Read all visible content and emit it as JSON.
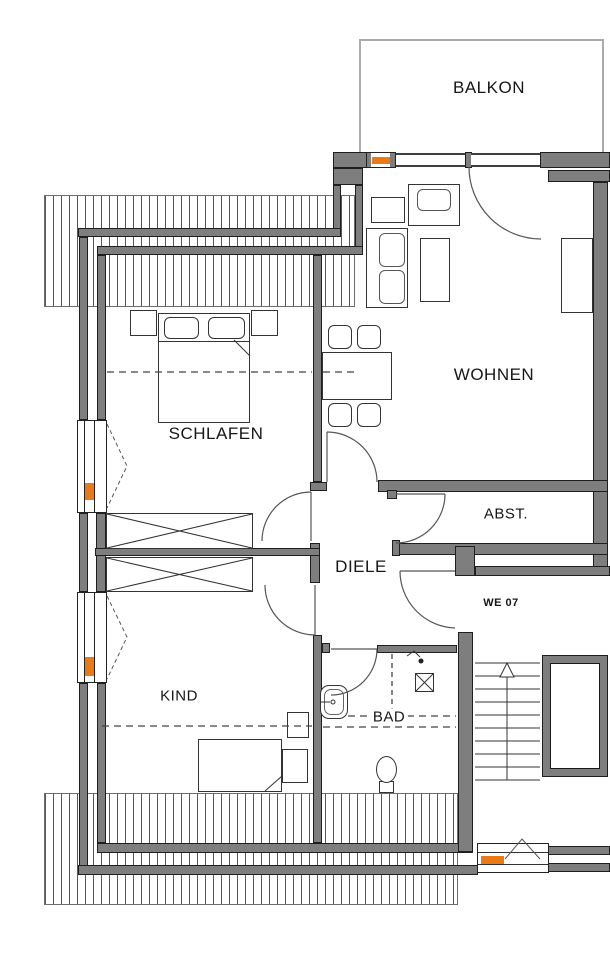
{
  "plan": {
    "unit_label": "WE 07",
    "rooms": [
      {
        "id": "balkon",
        "label": "BALKON"
      },
      {
        "id": "wohnen",
        "label": "WOHNEN"
      },
      {
        "id": "schlafen",
        "label": "SCHLAFEN"
      },
      {
        "id": "abst",
        "label": "ABST."
      },
      {
        "id": "diele",
        "label": "DIELE"
      },
      {
        "id": "kind",
        "label": "KIND"
      },
      {
        "id": "bad",
        "label": "BAD"
      }
    ],
    "stairs": {
      "direction": "up",
      "treads": 9
    },
    "colors": {
      "wall": "#7e7e7e",
      "window_marker": "#e87b17",
      "roof_hatch_line": "#565656",
      "balcony_outline": "#ababab"
    }
  }
}
